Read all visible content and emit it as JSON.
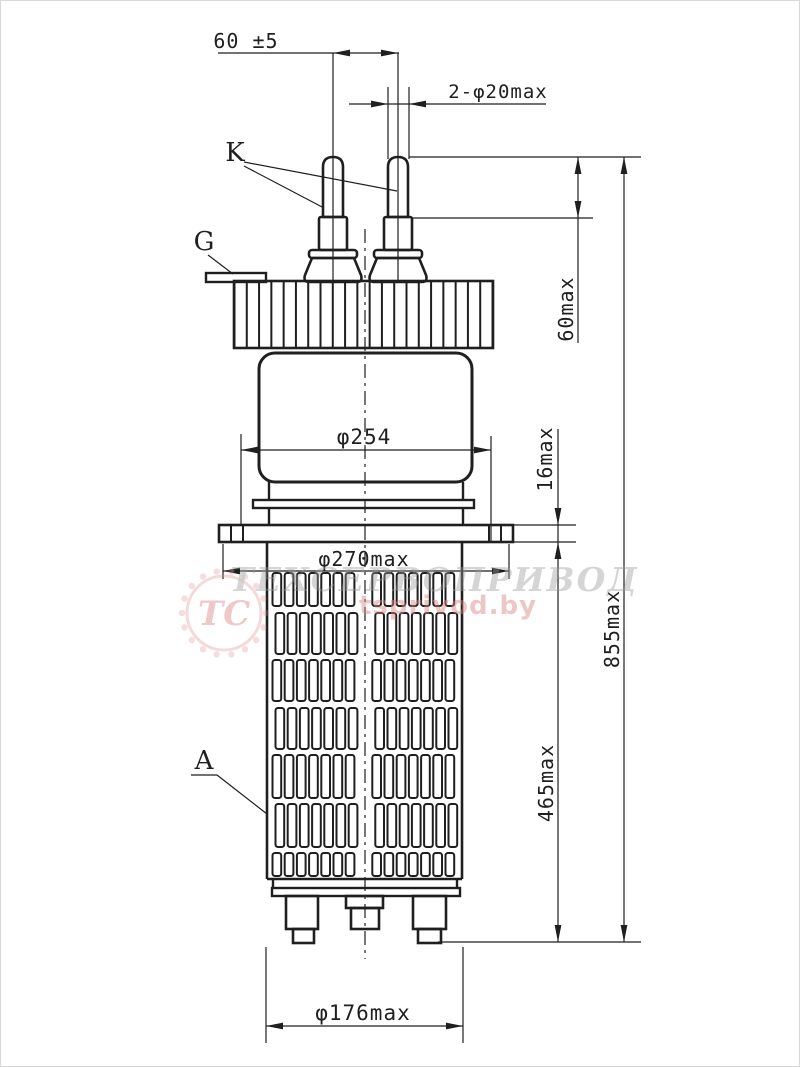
{
  "page": {
    "background": "#ffffff",
    "frame_color": "#d8d8d8"
  },
  "drawing": {
    "line_color": "#1f1f1f",
    "part_labels": {
      "cathode": "K",
      "grid": "G",
      "anode": "A"
    },
    "dimensions": {
      "pin_spacing": "60 ±5",
      "pin_diameter": "2-φ20max",
      "pin_height": "60max",
      "total_height": "855max",
      "body_diameter": "φ254",
      "flange_thickness": "16max",
      "flange_diameter": "φ270max",
      "radiator_height": "465max",
      "radiator_diameter": "φ176max"
    },
    "watermark": {
      "company": "ТЕХСЕРВОПРИВОД",
      "website": "tsprivod.by",
      "monogram": "ТС",
      "gray": "#9a9a9a",
      "pink": "#d98484"
    }
  }
}
